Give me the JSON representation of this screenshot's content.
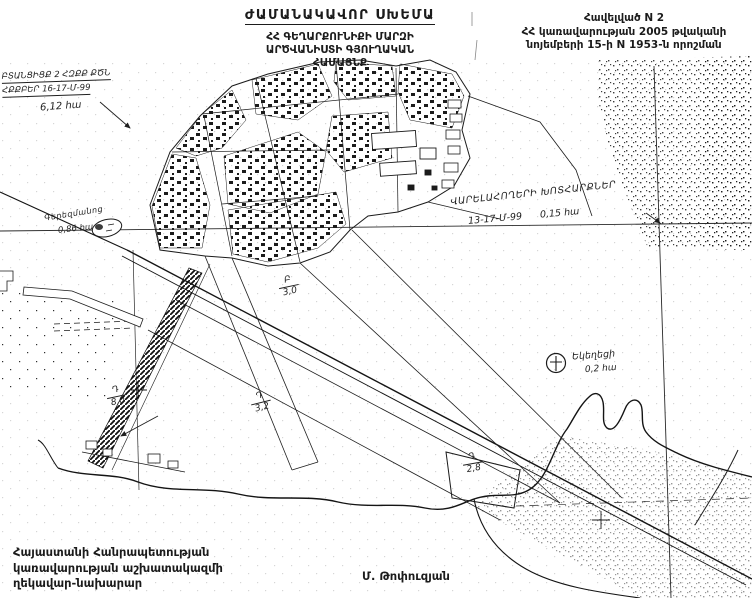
{
  "document": {
    "title": "ԺԱՄԱՆԱԿԱՎՈՐ ՍԽԵՄԱ",
    "subtitle_line1": "ՀՀ ԳԵՂԱՐՔՈՒՆԻՔԻ ՄԱՐԶԻ",
    "subtitle_line2": "ԱՐԾՎԱՆԻՍՏԻ ԳՅՈՒՂԱԿԱՆ",
    "subtitle_line3": "ՀԱՄԱՅՆՔ",
    "annex_line1": "Հավելված N 2",
    "annex_line2": "ՀՀ կառավարության 2005 թվականի",
    "annex_line3": "նոյեմբերի 15-ի N 1953-ն որոշման",
    "footer_line1": "Հայաստանի Հանրապետության",
    "footer_line2": "կառավարության աշխատակազմի",
    "footer_line3": "ղեկավար-նախարար",
    "signature": "Մ. Թոփուզյան"
  },
  "annotations": {
    "upper_left": {
      "line1": "ԲՏԱՆՑԻՑՔ 2 ՀԶՔՔ ՔԾՆ",
      "line2": "ՀՔՔԲԵՐ 16-17-Մ-99",
      "area": "6,12 հա"
    },
    "cemetery": {
      "name": "Գերեզմանոց",
      "area": "0,86 հա"
    },
    "arable": {
      "line1": "ՎԱՐԵԼԱՀՈՂԵՐԻ ԽՈՏՀԱՐՔՆԵՐ",
      "code": "13-17-Մ-99",
      "area": "0,15 հա"
    },
    "church": {
      "name": "Եկեղեցի",
      "area": "0,2 հա"
    }
  },
  "parcels": [
    {
      "code": "Բ",
      "area": "3,0"
    },
    {
      "code": "Դ",
      "area": "3,2"
    },
    {
      "code": "Դ",
      "area": "2,8"
    },
    {
      "code": "Դ",
      "area": "8,0"
    }
  ],
  "colors": {
    "ink": "#1b1b1b",
    "paper": "#ffffff"
  }
}
